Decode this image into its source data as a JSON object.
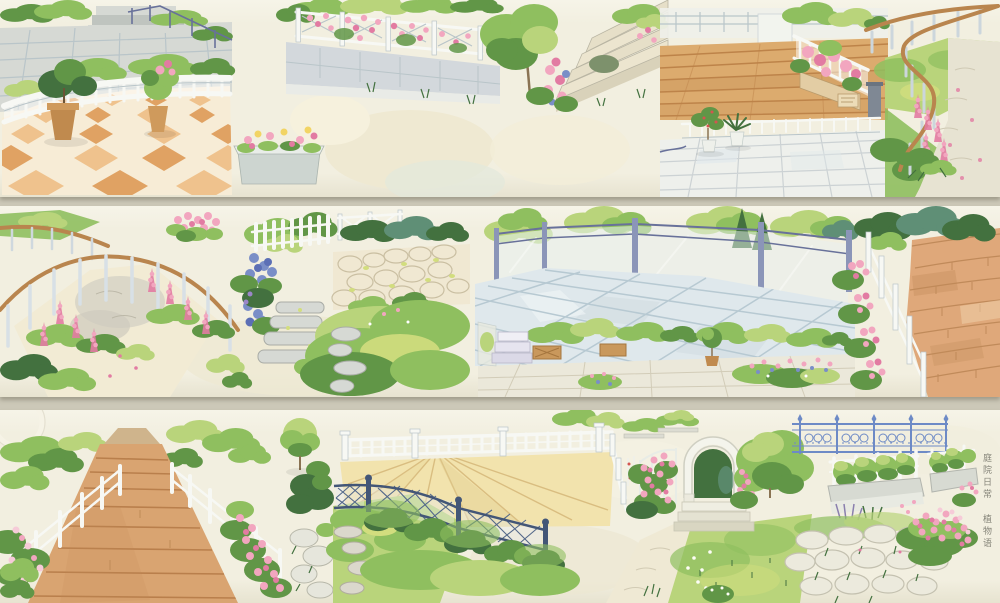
{
  "caption": {
    "text": "庭院日常 植物语"
  },
  "palette": {
    "bg": "#ccc8b8",
    "tape": "#f2efe0",
    "ink": "#6b6a60",
    "green_l": "#b9d47b",
    "green_m": "#8fbf5f",
    "green_d": "#619647",
    "green_deep": "#43713f",
    "green_teal": "#5f8f76",
    "green_y": "#d2dd7e",
    "pink": "#f2a6bf",
    "pink_d": "#e27ba2",
    "pink_pale": "#f6cbd8",
    "blue_f": "#7a8ec7",
    "white_f": "#f7f8f4",
    "fence_sh": "#b9c5c9",
    "stone": "#d6d9d4",
    "stone_d": "#aeb4b0",
    "metal": "#8b95b8",
    "metal_d": "#68719a",
    "lattice": "#53688a",
    "lattice_d": "#435677",
    "iron": "#6d8ac6",
    "rail_brown": "#b9854e",
    "wood": "#dcab6e",
    "wood_d": "#bd8349",
    "deck": "#f2e3ad",
    "deck_d": "#d9bd80",
    "boardwalk": "#d9a471",
    "boardwalk_d": "#b97f4c",
    "terr_cream": "#f7ecd6",
    "terr_peach": "#efc28d",
    "terr_orange": "#e0a263",
    "tile_blue": "#dfe8ec",
    "tile_blue_d": "#b7c9d2",
    "cream": "#f0ead2",
    "brick": "#dfa87a",
    "brick_d": "#c08a5a"
  },
  "rows": [
    {
      "name": "tape-strip-1",
      "scenes": [
        "stone-plaza",
        "checker-terrace",
        "rose-fence-wall",
        "flower-box",
        "tree-stairs",
        "wood-deck",
        "tile-plaza",
        "curved-fence-path"
      ]
    },
    {
      "name": "tape-strip-2",
      "scenes": [
        "curved-handrail-path",
        "flower-cluster",
        "picket-steps",
        "crossrail-cobbles",
        "meadow-stones",
        "blue-terrace",
        "steps-planters",
        "fence-brick-path"
      ]
    },
    {
      "name": "tape-strip-3",
      "scenes": [
        "boardwalk",
        "tree-and-stones",
        "white-balustrade-deck",
        "hedge-strips",
        "lattice-fence",
        "garden-arch",
        "iron-fence",
        "bench-planter",
        "small-planter",
        "cobbles-flowers"
      ]
    }
  ]
}
